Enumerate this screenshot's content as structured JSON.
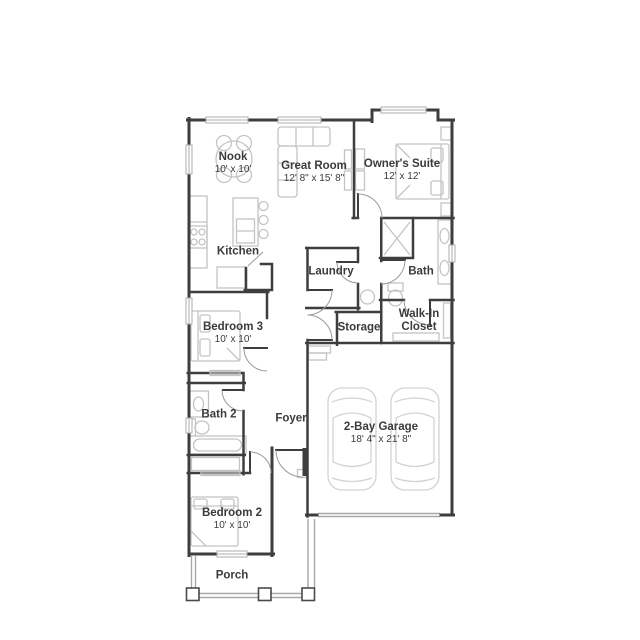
{
  "colors": {
    "wall": "#3e3e3e",
    "door": "#9a9a9a",
    "furniture": "#c4c4c4",
    "car": "#d2d2d2",
    "porch": "#a8a8a8",
    "window": "#aeaeae",
    "text": "#3b3b3b"
  },
  "rooms": [
    {
      "name": "Nook",
      "dims": "10' x 10'"
    },
    {
      "name": "Great Room",
      "dims": "12' 8\" x 15' 8\""
    },
    {
      "name": "Owner's Suite",
      "dims": "12' x 12'"
    },
    {
      "name": "Kitchen",
      "dims": ""
    },
    {
      "name": "Laundry",
      "dims": ""
    },
    {
      "name": "Bath",
      "dims": ""
    },
    {
      "name": "Storage",
      "dims": ""
    },
    {
      "name": "Walk-In\nCloset",
      "dims": ""
    },
    {
      "name": "Bedroom 3",
      "dims": "10' x 10'"
    },
    {
      "name": "Bath 2",
      "dims": ""
    },
    {
      "name": "Foyer",
      "dims": ""
    },
    {
      "name": "Bedroom 2",
      "dims": "10' x 10'"
    },
    {
      "name": "2-Bay Garage",
      "dims": "18' 4\" x 21' 8\""
    },
    {
      "name": "Porch",
      "dims": ""
    }
  ]
}
